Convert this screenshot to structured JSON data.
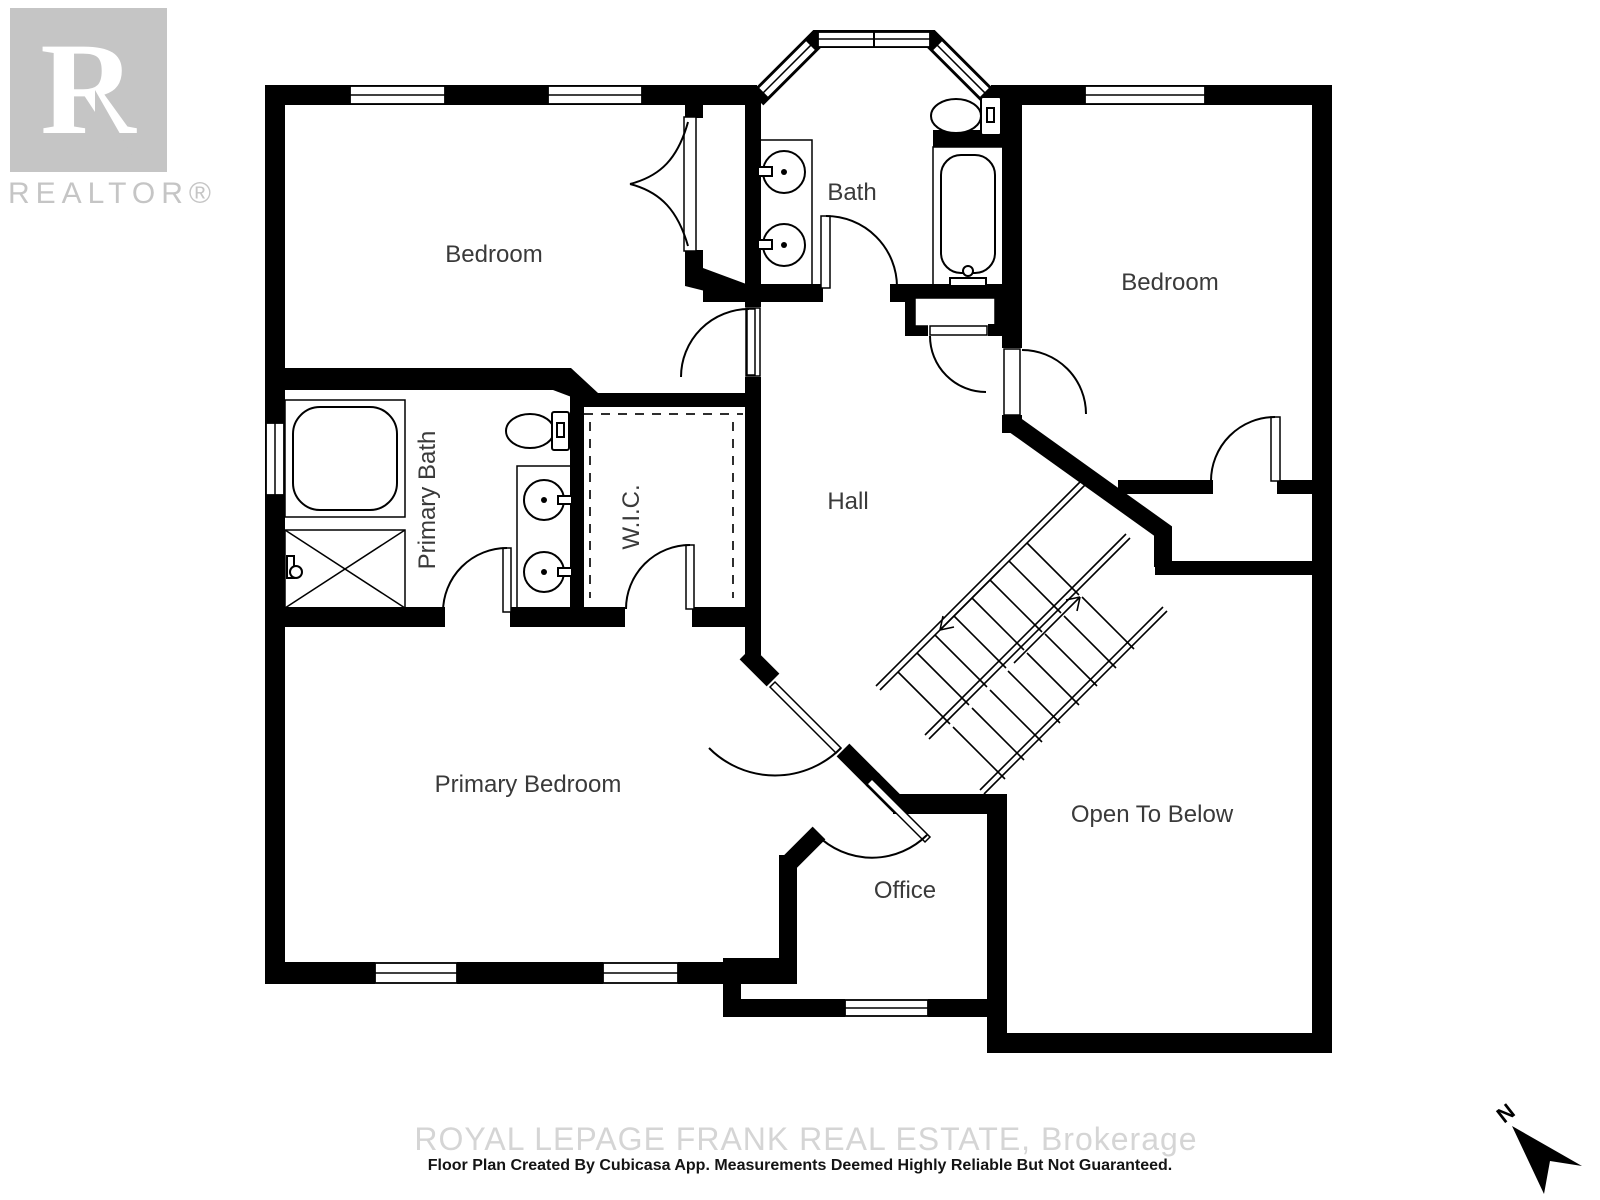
{
  "meta": {
    "type": "floor-plan",
    "width_px": 1600,
    "height_px": 1200,
    "background": "#ffffff"
  },
  "branding": {
    "logo_letter": "R",
    "logo_word": "REALTOR®",
    "logo_color": "#c5c5c5"
  },
  "rooms": {
    "bedroom_top_left": {
      "label": "Bedroom"
    },
    "bath": {
      "label": "Bath"
    },
    "bedroom_top_right": {
      "label": "Bedroom"
    },
    "primary_bath": {
      "label": "Primary Bath"
    },
    "wic": {
      "label": "W.I.C."
    },
    "hall": {
      "label": "Hall"
    },
    "primary_bedroom": {
      "label": "Primary Bedroom"
    },
    "office": {
      "label": "Office"
    },
    "open_to_below": {
      "label": "Open To Below"
    }
  },
  "fixtures": [
    "bay-window",
    "double-sink-vanity",
    "toilet",
    "bathtub",
    "corner-tub",
    "shower",
    "double-sink-vanity",
    "toilet",
    "linen-closet",
    "bifold-closet-doors",
    "staircase"
  ],
  "footer": {
    "watermark": "ROYAL LEPAGE FRANK REAL ESTATE, Brokerage",
    "disclaimer": "Floor Plan Created By Cubicasa App. Measurements Deemed Highly Reliable But Not Guaranteed."
  },
  "compass": {
    "label": "N"
  },
  "colors": {
    "wall": "#000000",
    "line": "#000000",
    "label": "#3a3a3a",
    "watermark": "#d5d5d5",
    "disclaimer": "#141414",
    "logo": "#c5c5c5"
  }
}
